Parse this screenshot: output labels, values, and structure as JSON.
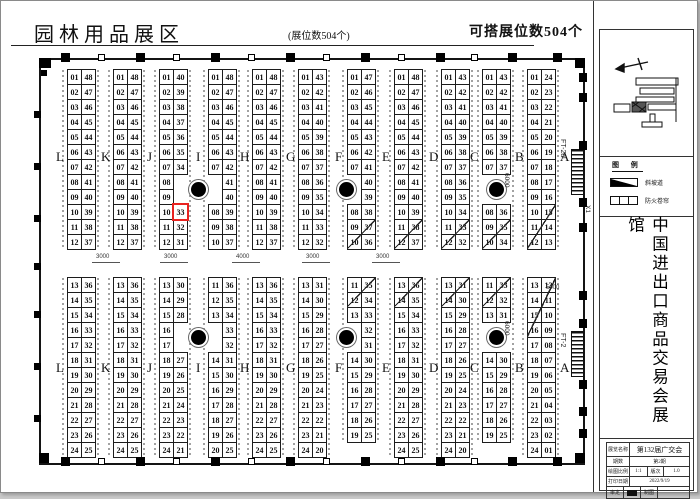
{
  "header": {
    "title": "园林用品展区",
    "booth_count": "(展位数504个)",
    "buildable_count": "可搭展位数504个"
  },
  "sidebar": {
    "legend": {
      "title": "图 例",
      "items": [
        "斜坡道",
        "防火卷帘"
      ]
    },
    "vertical_title": "中国进出口商品交易会展馆",
    "title_block": {
      "rows": [
        [
          "展览名称",
          "第132届广交会"
        ],
        [
          "期数",
          "第2期"
        ],
        [
          "绘图比例",
          "1:1",
          "版次",
          "1.0"
        ],
        [
          "打印日期",
          "2022/9/19"
        ],
        [
          "审定",
          "制图"
        ]
      ]
    }
  },
  "plan": {
    "aisle_letters": [
      "L",
      "K",
      "J",
      "I",
      "H",
      "G",
      "F",
      "E",
      "D",
      "C",
      "B",
      "A"
    ],
    "highlight_color": "#e82320",
    "highlighted_booth": "33",
    "dim_labels": [
      "3000",
      "3000",
      "4000",
      "3000",
      "3000"
    ],
    "edge_labels": {
      "ft2a": "FT-2a",
      "ft2": "FT-2",
      "x1": "X1",
      "d6000": "6000",
      "d5000": "5000"
    },
    "blocks_top": [
      {
        "left": [
          "01",
          "02",
          "03",
          "04",
          "05",
          "06",
          "07",
          "08",
          "09",
          "10",
          "11",
          "12"
        ],
        "right": [
          "48",
          "47",
          "46",
          "45",
          "44",
          "43",
          "42",
          "41",
          "40",
          "39",
          "38",
          "37"
        ]
      },
      {
        "left": [
          "01",
          "02",
          "03",
          "04",
          "05",
          "06",
          "07",
          "08",
          "09",
          "10",
          "11",
          "12"
        ],
        "right": [
          "48",
          "47",
          "46",
          "45",
          "44",
          "43",
          "42",
          "41",
          "40",
          "39",
          "38",
          "37"
        ]
      },
      {
        "left": [
          "01",
          "02",
          "03",
          "04",
          "05",
          "06",
          "07",
          "08",
          "09",
          "10",
          "11",
          "12"
        ],
        "right": [
          "40",
          "39",
          "38",
          "37",
          "36",
          "35",
          "34",
          "",
          "",
          "33",
          "32",
          "31"
        ],
        "hl": {
          "col": "right",
          "row": 9
        }
      },
      {
        "left": [
          "01",
          "02",
          "03",
          "04",
          "05",
          "06",
          "07",
          "",
          "",
          "08",
          "09",
          "10"
        ],
        "right": [
          "48",
          "47",
          "46",
          "45",
          "44",
          "43",
          "42",
          "41",
          "40",
          "39",
          "38",
          "37"
        ]
      },
      {
        "left": [
          "01",
          "02",
          "03",
          "04",
          "05",
          "06",
          "07",
          "08",
          "09",
          "10",
          "11",
          "12"
        ],
        "right": [
          "48",
          "47",
          "46",
          "45",
          "44",
          "43",
          "42",
          "41",
          "40",
          "39",
          "38",
          "37"
        ]
      },
      {
        "left": [
          "01",
          "02",
          "03",
          "04",
          "05",
          "06",
          "07",
          "08",
          "09",
          "10",
          "11",
          "12"
        ],
        "right": [
          "43",
          "42",
          "41",
          "40",
          "39",
          "38",
          "37",
          "36",
          "35",
          "34",
          "33",
          "32"
        ]
      },
      {
        "left": [
          "01",
          "02",
          "03",
          "04",
          "05",
          "06",
          "07",
          "",
          "",
          "08",
          "09",
          "10"
        ],
        "right": [
          "47",
          "46",
          "45",
          "44",
          "43",
          "42",
          "41",
          "40",
          "39",
          "38",
          "37",
          "36"
        ],
        "diag": [
          10,
          11
        ]
      },
      {
        "left": [
          "01",
          "02",
          "03",
          "04",
          "05",
          "06",
          "07",
          "08",
          "09",
          "10",
          "11",
          "12"
        ],
        "right": [
          "48",
          "47",
          "46",
          "45",
          "44",
          "43",
          "42",
          "41",
          "40",
          "39",
          "38",
          "37"
        ],
        "diag": [
          10,
          11
        ]
      },
      {
        "left": [
          "01",
          "02",
          "03",
          "04",
          "05",
          "06",
          "07",
          "08",
          "09",
          "10",
          "11",
          "12"
        ],
        "right": [
          "43",
          "42",
          "41",
          "40",
          "39",
          "38",
          "37",
          "36",
          "35",
          "34",
          "33",
          "32"
        ],
        "diag": [
          10,
          11
        ]
      },
      {
        "left": [
          "01",
          "02",
          "03",
          "04",
          "05",
          "06",
          "07",
          "",
          "",
          "08",
          "09",
          "10"
        ],
        "right": [
          "43",
          "42",
          "41",
          "40",
          "39",
          "38",
          "37",
          "",
          "",
          "36",
          "35",
          "34"
        ],
        "diag": [
          10,
          11
        ]
      },
      {
        "left": [
          "01",
          "02",
          "03",
          "04",
          "05",
          "06",
          "07",
          "08",
          "09",
          "10",
          "11",
          "12"
        ],
        "right": [
          "24",
          "23",
          "22",
          "21",
          "20",
          "19",
          "18",
          "17",
          "16",
          "15",
          "14",
          "13"
        ],
        "diag": [
          9,
          11
        ]
      }
    ],
    "blocks_bottom": [
      {
        "left": [
          "13",
          "14",
          "15",
          "16",
          "17",
          "18",
          "19",
          "20",
          "21",
          "22",
          "23",
          "24"
        ],
        "right": [
          "36",
          "35",
          "34",
          "33",
          "32",
          "31",
          "30",
          "29",
          "28",
          "27",
          "26",
          "25"
        ]
      },
      {
        "left": [
          "13",
          "14",
          "15",
          "16",
          "17",
          "18",
          "19",
          "20",
          "21",
          "22",
          "23",
          "24"
        ],
        "right": [
          "36",
          "35",
          "34",
          "33",
          "32",
          "31",
          "30",
          "29",
          "28",
          "27",
          "26",
          "25"
        ]
      },
      {
        "left": [
          "13",
          "14",
          "15",
          "16",
          "17",
          "18",
          "19",
          "20",
          "21",
          "22",
          "23",
          "24"
        ],
        "right": [
          "30",
          "29",
          "28",
          "",
          "",
          "27",
          "26",
          "25",
          "24",
          "23",
          "22",
          "21"
        ]
      },
      {
        "left": [
          "11",
          "12",
          "13",
          "",
          "",
          "14",
          "15",
          "16",
          "17",
          "18",
          "19",
          "20"
        ],
        "right": [
          "36",
          "35",
          "34",
          "33",
          "32",
          "31",
          "30",
          "29",
          "28",
          "27",
          "26",
          "25"
        ]
      },
      {
        "left": [
          "13",
          "14",
          "15",
          "16",
          "17",
          "18",
          "19",
          "20",
          "21",
          "22",
          "23",
          "24"
        ],
        "right": [
          "36",
          "35",
          "34",
          "33",
          "32",
          "31",
          "30",
          "29",
          "28",
          "27",
          "26",
          "25"
        ]
      },
      {
        "left": [
          "13",
          "14",
          "15",
          "16",
          "17",
          "18",
          "19",
          "20",
          "21",
          "22",
          "23",
          "24"
        ],
        "right": [
          "31",
          "30",
          "29",
          "28",
          "27",
          "26",
          "25",
          "24",
          "23",
          "22",
          "21",
          "20"
        ]
      },
      {
        "left": [
          "11",
          "12",
          "13",
          "",
          "",
          "14",
          "15",
          "16",
          "17",
          "18",
          "19",
          ""
        ],
        "right": [
          "35",
          "34",
          "33",
          "32",
          "31",
          "30",
          "29",
          "28",
          "27",
          "26",
          "25",
          ""
        ],
        "diag": [
          0,
          1
        ]
      },
      {
        "left": [
          "13",
          "14",
          "15",
          "16",
          "17",
          "18",
          "19",
          "20",
          "21",
          "22",
          "23",
          "24"
        ],
        "right": [
          "36",
          "35",
          "34",
          "33",
          "32",
          "31",
          "30",
          "29",
          "28",
          "27",
          "26",
          "25"
        ],
        "diag": [
          0,
          1
        ]
      },
      {
        "left": [
          "13",
          "14",
          "15",
          "16",
          "17",
          "18",
          "19",
          "20",
          "21",
          "22",
          "23",
          "24"
        ],
        "right": [
          "31",
          "30",
          "29",
          "28",
          "27",
          "26",
          "25",
          "24",
          "23",
          "22",
          "21",
          "20"
        ],
        "diag": [
          0,
          1
        ]
      },
      {
        "left": [
          "11",
          "12",
          "13",
          "",
          "",
          "14",
          "15",
          "16",
          "17",
          "18",
          "19",
          ""
        ],
        "right": [
          "33",
          "32",
          "31",
          "",
          "",
          "30",
          "29",
          "28",
          "27",
          "26",
          "25",
          ""
        ],
        "diag": [
          0,
          1
        ]
      },
      {
        "left": [
          "13",
          "14",
          "15",
          "16",
          "17",
          "18",
          "19",
          "20",
          "21",
          "22",
          "23",
          "24"
        ],
        "right": [
          "12",
          "11",
          "10",
          "09",
          "08",
          "07",
          "06",
          "05",
          "04",
          "03",
          "02",
          "01"
        ],
        "diag": [
          0,
          3
        ]
      }
    ]
  }
}
